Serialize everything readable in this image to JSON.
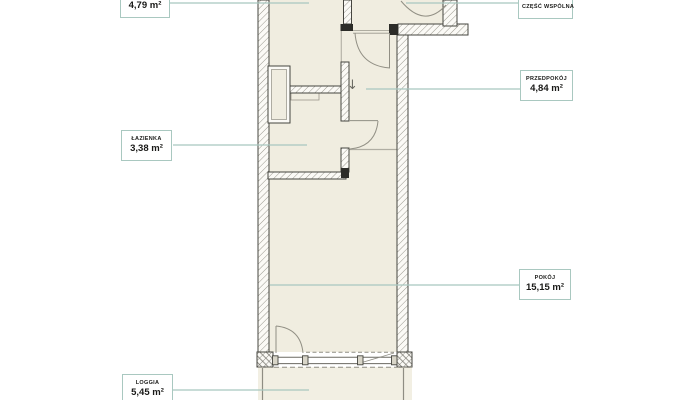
{
  "page": {
    "type": "apartment-floor-plan",
    "background": "#ffffff"
  },
  "plan": {
    "colors": {
      "room_fill": "#f0ede0",
      "loggia_fill": "#f2efe3",
      "wall_fill": "#fbfaf6",
      "wall_outline": "#45453f",
      "hatch_line": "#8f8d83",
      "black_post": "#2c2c28",
      "door_line": "#918f84",
      "leader_line": "#a8c7bf",
      "label_border": "#a9c8c0",
      "label_text": "#1a1a18"
    },
    "entrance_arrow": "↓"
  },
  "labels": [
    {
      "name": "",
      "area": "4,79 m²"
    },
    {
      "name": "CZĘŚĆ WSPÓLNA",
      "area": ""
    },
    {
      "name": "PRZEDPOKÓJ",
      "area": "4,84 m²"
    },
    {
      "name": "ŁAZIENKA",
      "area": "3,38 m²"
    },
    {
      "name": "POKÓJ",
      "area": "15,15 m²"
    },
    {
      "name": "LOGGIA",
      "area": "5,45 m²"
    }
  ]
}
